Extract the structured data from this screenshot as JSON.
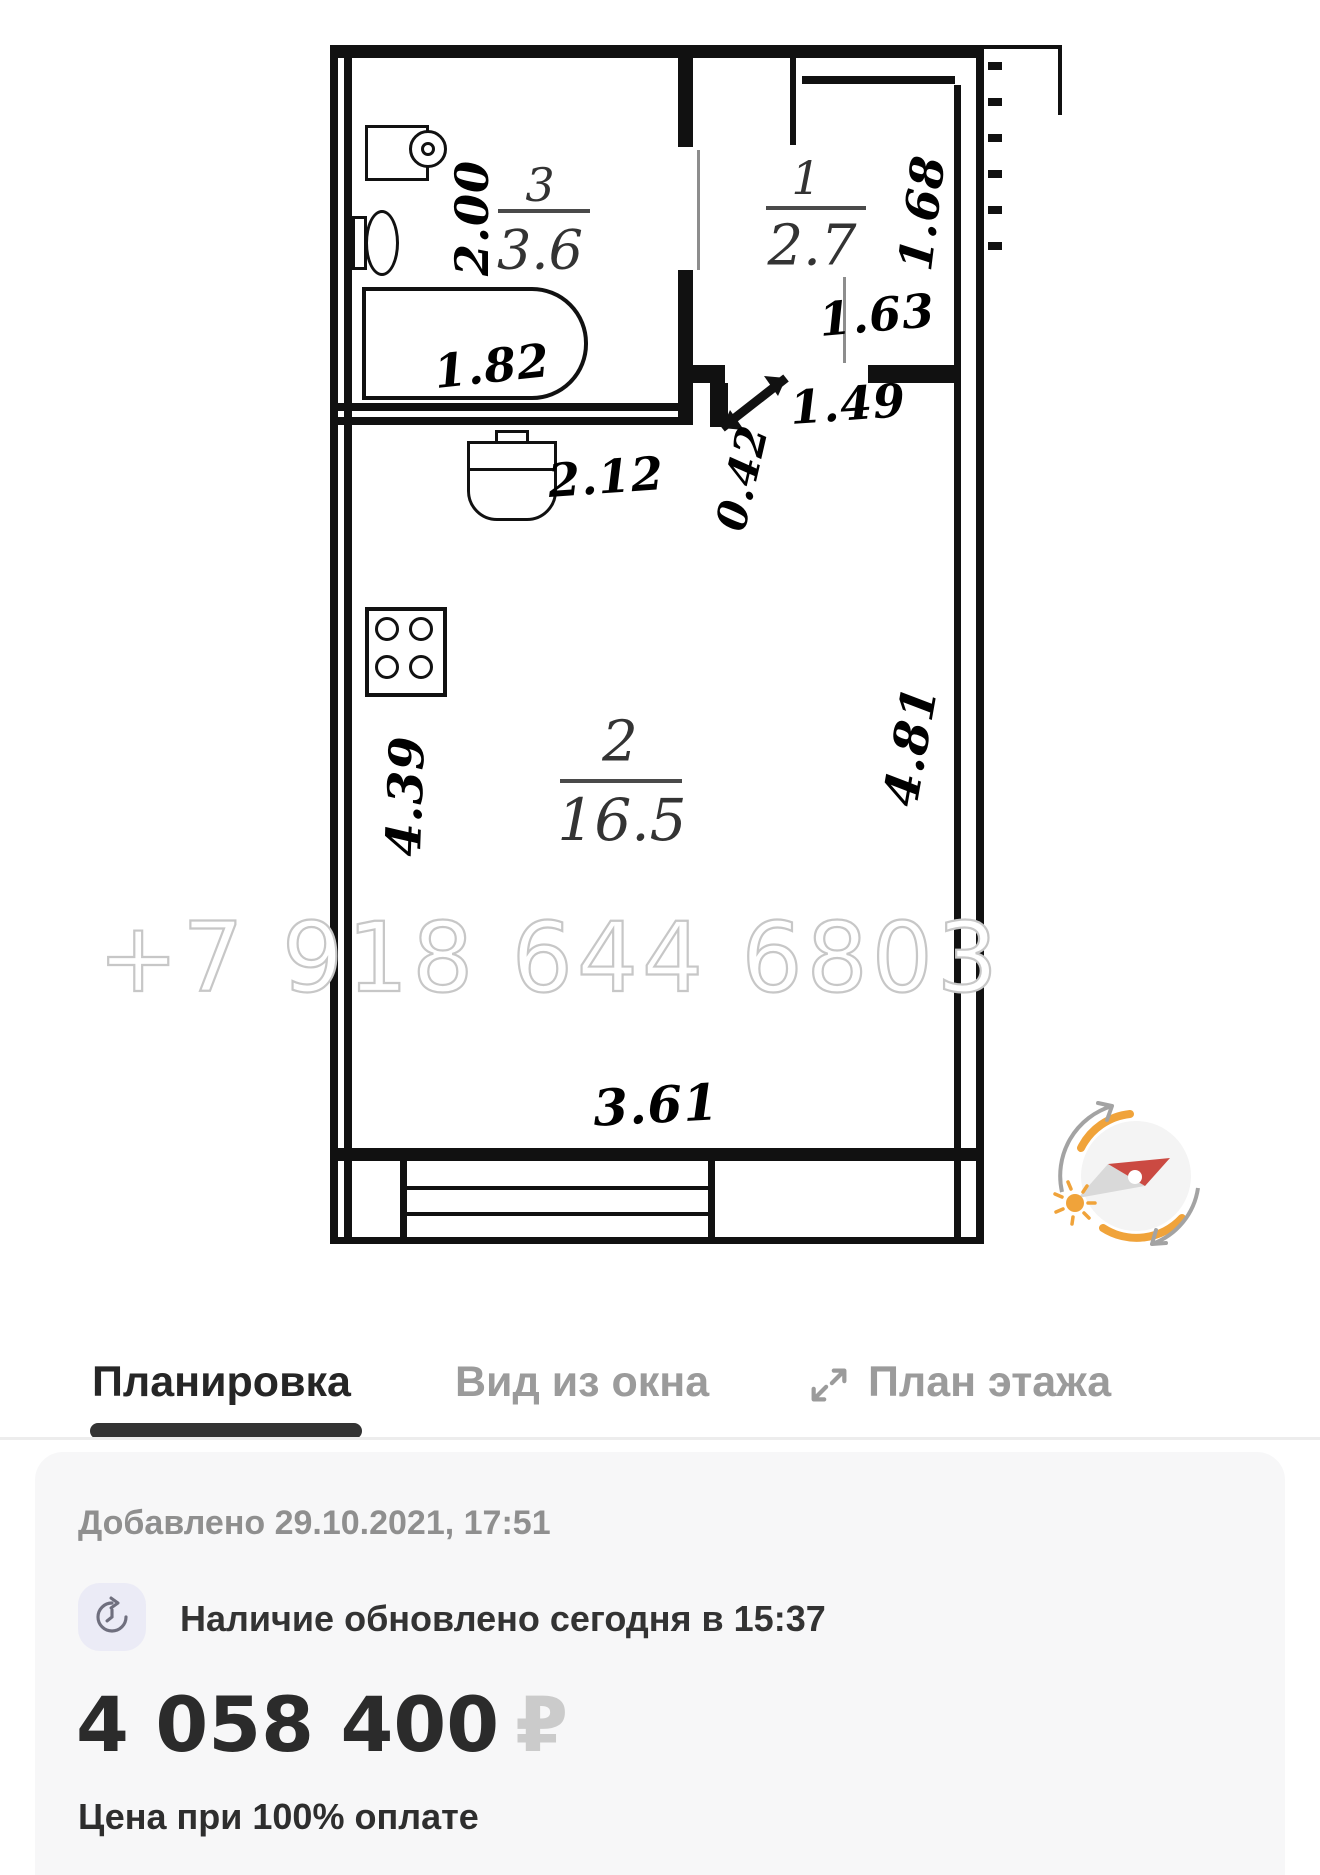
{
  "plan": {
    "watermark": "+7 918 644 6803",
    "rooms": {
      "bathroom": {
        "num": "3",
        "area": "3.6"
      },
      "hall": {
        "num": "1",
        "area": "2.7"
      },
      "living": {
        "num": "2",
        "area": "16.5"
      }
    },
    "dims": {
      "bath_width": "2.00",
      "tub_length": "1.82",
      "hall_depth": "1.68",
      "hall_width": "1.63",
      "entry_opening": "1.49",
      "jamb": "0.42",
      "kitchen_wall": "2.12",
      "room_left": "4.39",
      "room_right": "4.81",
      "room_bottom": "3.61"
    }
  },
  "tabs": {
    "layout": "Планировка",
    "window_view": "Вид из окна",
    "floor_plan": "План этажа"
  },
  "info": {
    "added": "Добавлено 29.10.2021, 17:51",
    "availability": "Наличие обновлено сегодня в 15:37",
    "price": "4 058 400",
    "currency": "₽",
    "price_note": "Цена при 100% оплате"
  },
  "colors": {
    "accent_orange": "#F0A33A",
    "needle_red": "#CB4A42",
    "tab_active": "#2F2F2F",
    "tab_inactive": "#9B9B9B"
  }
}
